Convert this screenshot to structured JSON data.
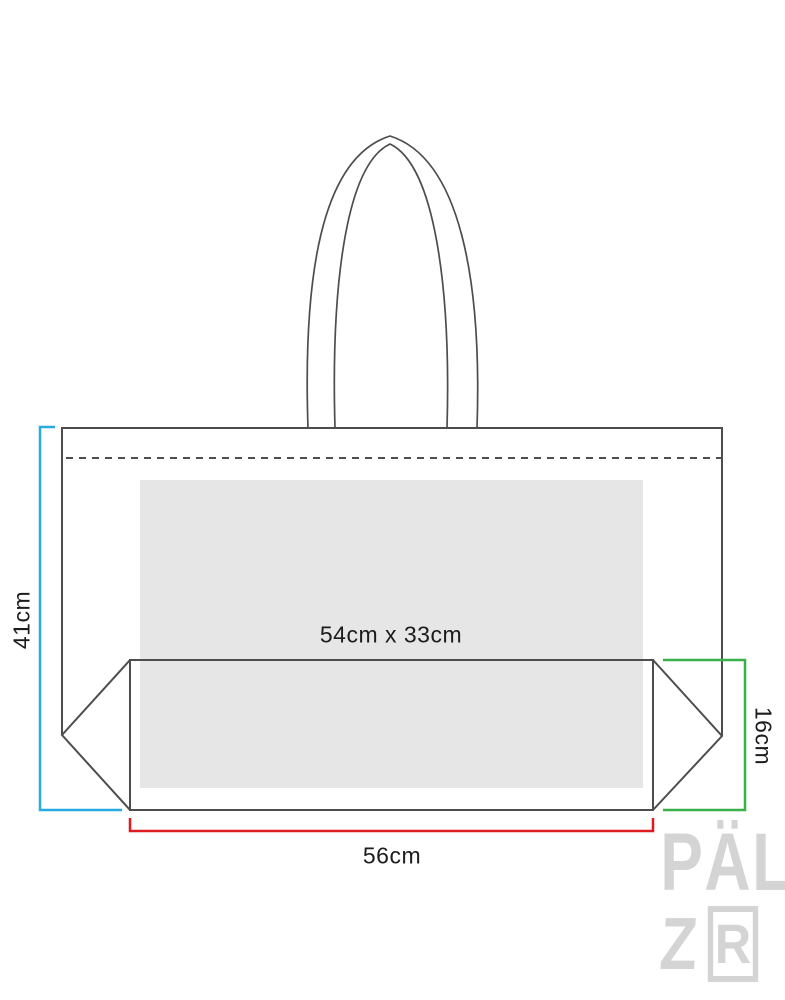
{
  "diagram": {
    "type": "product-dimension-drawing",
    "subject": "tote-bag-with-gusset",
    "labels": {
      "bag_height": "41cm",
      "print_area": "54cm x 33cm",
      "bag_width": "56cm",
      "gusset_depth": "16cm"
    },
    "colors": {
      "height_dimension_line": "#29abe2",
      "width_dimension_line": "#dd1b21",
      "depth_dimension_line": "#3bb04a",
      "outline": "#4d4d4d",
      "print_area_fill": "#e6e6e6",
      "label_text": "#1c1c1c",
      "watermark": "#d4d4d4"
    },
    "watermark": {
      "line1": "PÄL",
      "line2_z": "Z",
      "line2_r": "R"
    }
  }
}
